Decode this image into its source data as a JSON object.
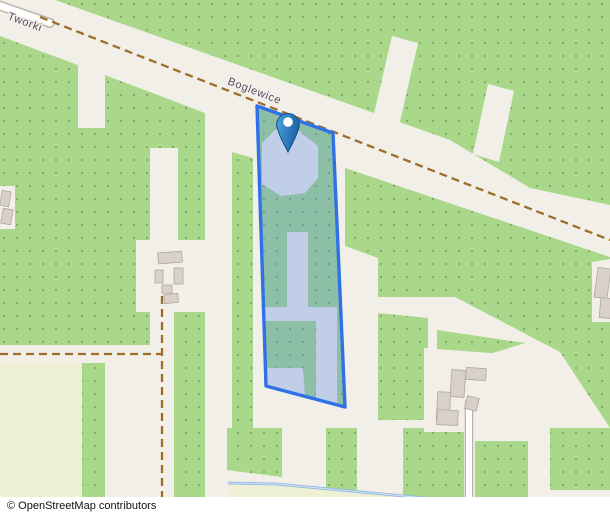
{
  "attribution": {
    "text": "© OpenStreetMap contributors"
  },
  "map": {
    "road_labels": [
      {
        "id": "tworki",
        "text": "Tworki"
      },
      {
        "id": "boglewice",
        "text": "Boglewice"
      }
    ],
    "marker": {
      "icon": "map-pin-icon",
      "color": "#2e86c8"
    },
    "parcel": {
      "stroke_color": "#2f72e8",
      "fill_color": "rgba(77,129,232,0.30)"
    },
    "colors": {
      "land": "#f2efe9",
      "vegetation": "#aad88a",
      "vegetation_dot": "#7d9c64",
      "farmland": "#eef0d5",
      "track": "#9e6e28",
      "road_fill": "#ffffff",
      "road_casing": "#b9b3a9",
      "building": "#d9d0c9",
      "building_outline": "#b1a79c",
      "stream": "#8fb7dc",
      "label": "#5a4a63"
    }
  }
}
